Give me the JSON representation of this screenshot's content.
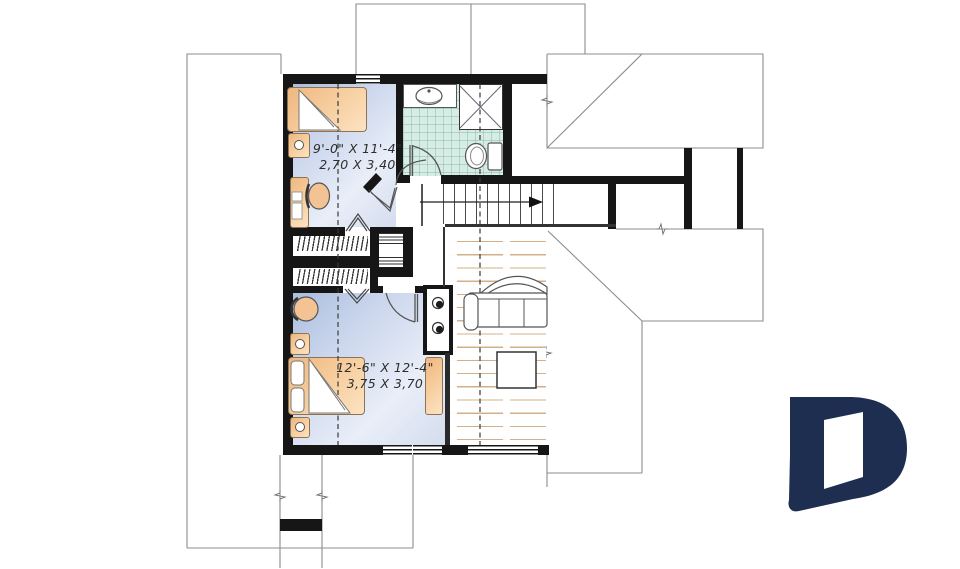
{
  "plan": {
    "bedroom1": {
      "dim_imperial": "9'-0\" X 11'-4\"",
      "dim_metric": "2,70 X 3,40"
    },
    "bedroom2": {
      "dim_imperial": "12'-6\" X 12'-4\"",
      "dim_metric": "3,75 X 3,70"
    }
  },
  "colors": {
    "wall_black": "#161616",
    "bedroom_floor_blue": "#c9d5ec",
    "furniture_orange": "#f5c997",
    "bathroom_tile_teal": "#d8ece6",
    "wood_floor_tan": "#d2b08a",
    "roof_line_gray": "#8d8d8d",
    "logo_navy": "#1e2e50"
  }
}
